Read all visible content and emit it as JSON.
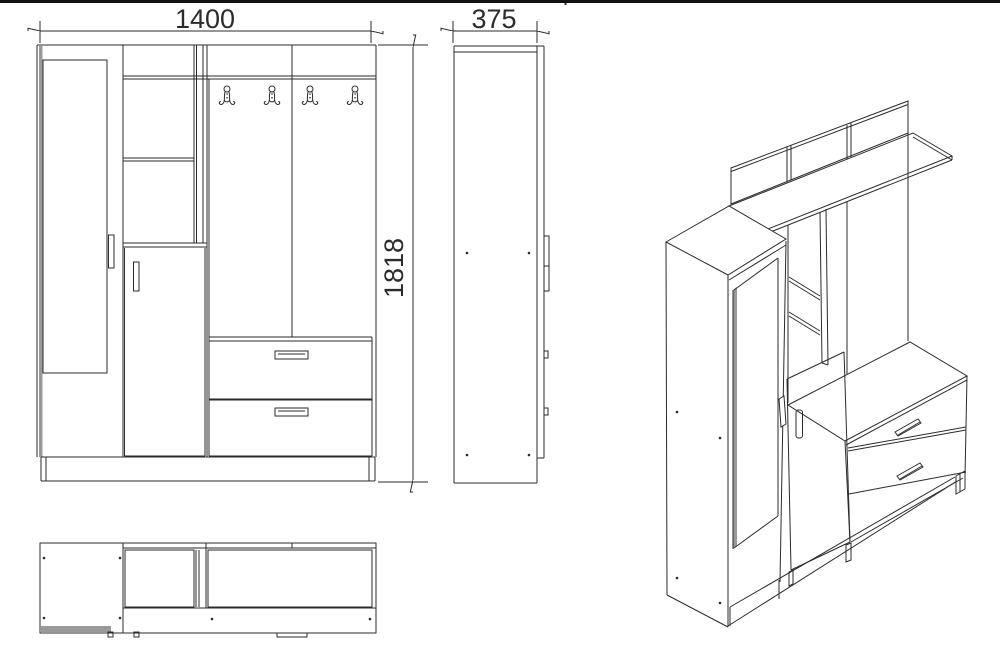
{
  "page": {
    "background": "#ffffff",
    "ink": "#2b2b2b",
    "shade": "#999999",
    "top_border": "true"
  },
  "drawing": {
    "title": "hallway-wardrobe-technical-drawing",
    "dimensions": {
      "width_mm": "1400",
      "depth_mm": "375",
      "height_mm": "1818"
    },
    "front_view": {
      "hooks": [
        227,
        272,
        310,
        355
      ],
      "hook_y": 99
    },
    "side_view": {
      "screw_dots": [
        [
          467,
          253
        ],
        [
          529,
          253
        ],
        [
          467,
          455
        ],
        [
          529,
          455
        ]
      ]
    },
    "top_view": {
      "screw_dots": [
        [
          44,
          558
        ],
        [
          120,
          558
        ],
        [
          44,
          618
        ],
        [
          120,
          618
        ],
        [
          212,
          619
        ],
        [
          370,
          619
        ]
      ]
    },
    "iso_view": {
      "screw_dots": [
        [
          677,
          412
        ],
        [
          720,
          438
        ],
        [
          677,
          578
        ],
        [
          720,
          603
        ]
      ]
    }
  }
}
